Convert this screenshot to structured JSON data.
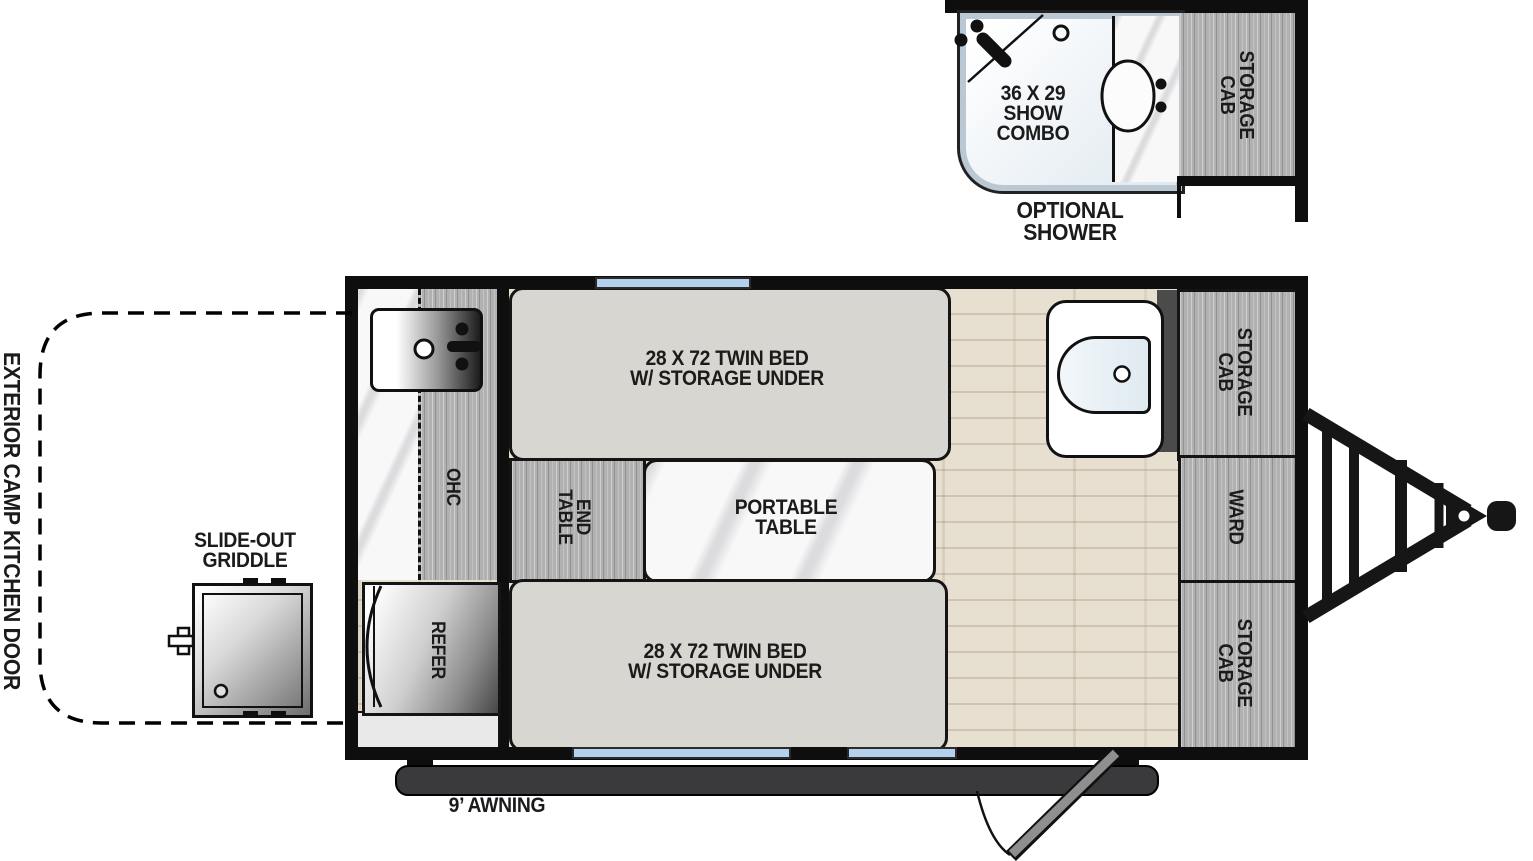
{
  "main": {
    "bed_top": "28 X 72 TWIN BED\nW/ STORAGE UNDER",
    "bed_bottom": "28 X 72 TWIN BED\nW/ STORAGE UNDER",
    "end_table": "END\nTABLE",
    "portable_table": "PORTABLE\nTABLE",
    "ohc": "OHC",
    "refer": "REFER",
    "storage_cab_top": "STORAGE\nCAB",
    "ward": "WARD",
    "storage_cab_bottom": "STORAGE\nCAB"
  },
  "optional_shower_inset": {
    "shower_combo": "36 X 29\nSHOW\nCOMBO",
    "storage_cab": "STORAGE\nCAB",
    "caption": "OPTIONAL\nSHOWER"
  },
  "exterior": {
    "camp_kitchen_door": "EXTERIOR CAMP KITCHEN DOOR",
    "slide_out_griddle": "SLIDE-OUT\nGRIDDLE",
    "awning": "9’ AWNING"
  },
  "colors": {
    "wall": "#0e0e0e",
    "window_blue": "#b3d1ec",
    "bed_fill": "#d8d6d1",
    "cabinet_gray": "#b1b1b1",
    "floor_tan": "#e7dfd0",
    "awning_bar": "#3a3a3c",
    "door_leaf": "#8f8f8f"
  }
}
